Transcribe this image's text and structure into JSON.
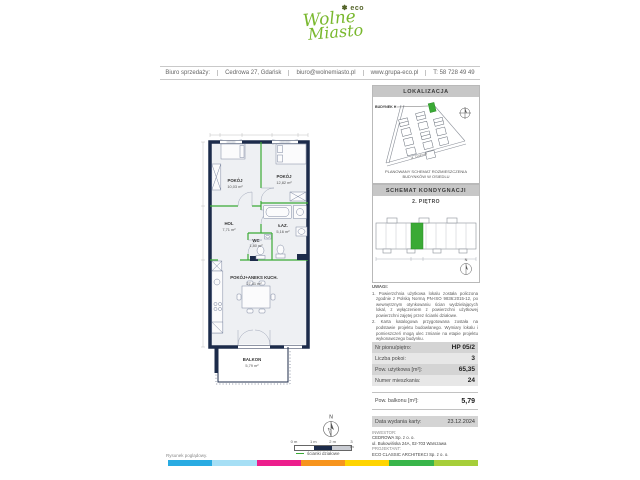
{
  "logo": {
    "eco": "✽ eco",
    "line1": "Wolne",
    "line2": "Miasto"
  },
  "contact": {
    "items": [
      "Biuro sprzedaży:",
      "Cedrowa 27, Gdańsk",
      "biuro@wolnemiasto.pl",
      "www.grupa-eco.pl",
      "T: 58 728 49 49"
    ]
  },
  "plan": {
    "rooms": [
      {
        "name": "POKÓJ",
        "area": "10,03 m²"
      },
      {
        "name": "POKÓJ",
        "area": "12,82 m²"
      },
      {
        "name": "HOL",
        "area": "7,71 m²"
      },
      {
        "name": "ŁAZ.",
        "area": "5,16 m²"
      },
      {
        "name": "WC",
        "area": "1,80 m²"
      },
      {
        "name": "POKÓJ+ANEKS KUCH.",
        "area": "27,41 m²"
      },
      {
        "name": "BALKON",
        "area": "5,79 m²"
      }
    ],
    "compass_n": "N"
  },
  "location": {
    "header": "LOKALIZACJA",
    "building_label": "BUDYNEK H",
    "street": "ul. Cedrowa",
    "caption": "PLANOWANY SCHEMAT ROZMIESZCZENIA BUDYNKÓW W OSIEDLU"
  },
  "floor_schema": {
    "header": "SCHEMAT KONDYGNACJI",
    "floor": "2. PIĘTRO",
    "compass_n": "N"
  },
  "notes": {
    "title": "UWAGI:",
    "items": [
      "1. Powierzchnia użytkowa lokalu została policzona zgodnie z Polską Normą PN-ISO 9836:2015-12, po wewnętrznym otynkowaniu ścian wydzielających lokal, z wyłączeniem z powierzchni użytkowej powierzchni zajętej przez ścianki działowe.",
      "2. Karta katalogowa przygotowana została na podstawie projektu budowlanego. Wymiary lokalu i pomieszczeń mogą ulec zmianie na etapie projektu wykonawczego budynku.",
      "3. Numeracja lokali może ulec zmianie.",
      "4. Wyjaśnienia symboli znajdują się w specyfikacji technicznej lokalu mieszkalnego."
    ]
  },
  "details": {
    "rows": [
      {
        "label": "Nr pionu/piętro:",
        "value": "HP 05/2"
      },
      {
        "label": "Liczba pokoi:",
        "value": "3"
      },
      {
        "label": "Pow. użytkowa [m²]:",
        "value": "65,35"
      },
      {
        "label": "Numer mieszkania:",
        "value": "24"
      },
      {
        "label": "Pow. balkonu [m²]:",
        "value": "5,79"
      },
      {
        "label": "Data wydania karty:",
        "value": "23.12.2024"
      }
    ]
  },
  "credits": {
    "investor_label": "INWESTOR:",
    "investor_name": "CEDROWA Sp. z o. o.",
    "investor_address": "ul. Bukowińska 24A, 02-703 Warszawa",
    "designer_label": "PROJEKTANT:",
    "designer_name": "ECO CLASSIC ARCHITEKCI Sp. z o. o."
  },
  "scale_bar": {
    "labels": [
      "0 m",
      "1 m",
      "2 m",
      "3 m"
    ],
    "legend": "ścianki działowe",
    "note": "Rysunek poglądowy."
  },
  "colors": {
    "accent_green": "#3aaa35",
    "wall_navy": "#1c2b4a",
    "stripe": [
      "#29abe2",
      "#a6dff5",
      "#ec1e8c",
      "#f7941d",
      "#ffd400",
      "#39b54a",
      "#a6ce39"
    ]
  }
}
